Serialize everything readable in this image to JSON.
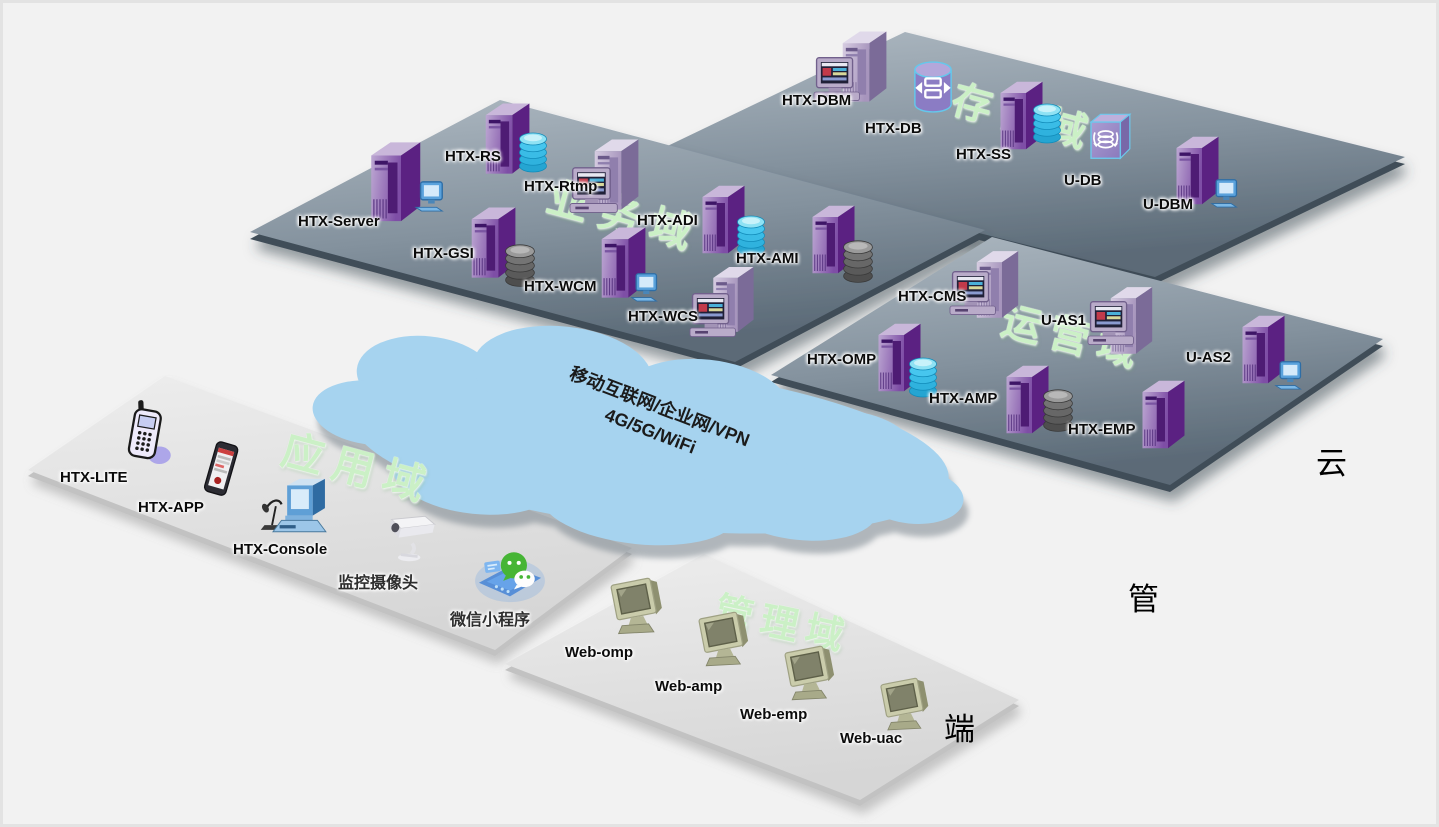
{
  "diagram": {
    "cloud_text": {
      "line1": "移动互联网/企业网/VPN",
      "line2": "4G/5G/WiFi"
    },
    "side_labels": {
      "cloud": "云",
      "pipe": "管",
      "terminal": "端"
    },
    "domains": {
      "storage": {
        "label": "存储域",
        "devices": [
          "HTX-DBM",
          "HTX-DB",
          "HTX-SS",
          "U-DB",
          "U-DBM"
        ]
      },
      "business": {
        "label": "业务域",
        "devices": [
          "HTX-Server",
          "HTX-RS",
          "HTX-Rtmp",
          "HTX-GSI",
          "HTX-ADI",
          "HTX-WCM",
          "HTX-AMI",
          "HTX-WCS"
        ]
      },
      "operations": {
        "label": "运营域",
        "devices": [
          "HTX-CMS",
          "HTX-OMP",
          "HTX-AMP",
          "U-AS1",
          "U-AS2",
          "HTX-EMP"
        ]
      },
      "application": {
        "label": "应用域",
        "devices": [
          "HTX-LITE",
          "HTX-APP",
          "HTX-Console",
          "监控摄像头",
          "微信小程序"
        ]
      },
      "management": {
        "label": "管理域",
        "devices": [
          "Web-omp",
          "Web-amp",
          "Web-emp",
          "Web-uac"
        ]
      }
    },
    "colors": {
      "platform_dark": "#7b8b98",
      "platform_light": "#e3e3e3",
      "cloud_fill": "#a6d3ef",
      "domain_label_green": "#cbf0c6",
      "server_purple": "#7e4ea6",
      "disk_cyan": "#2fb2de",
      "wechat_green": "#46b535"
    }
  }
}
